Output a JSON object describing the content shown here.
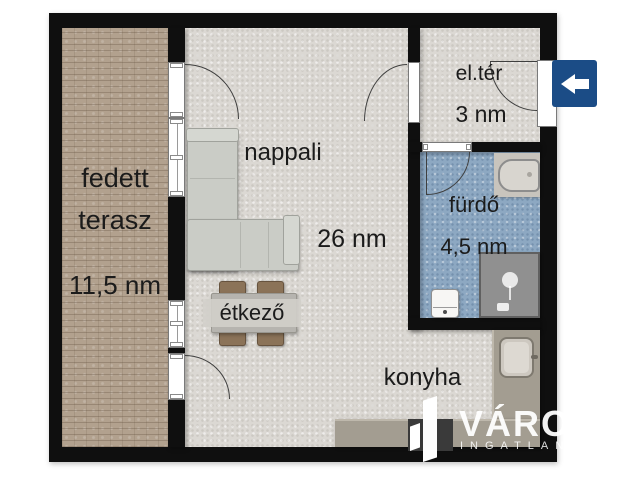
{
  "plan": {
    "rooms": {
      "terrace": {
        "line1": "fedett",
        "line2": "terasz",
        "area": "11,5 nm"
      },
      "living": {
        "name": "nappali",
        "area": "26 nm"
      },
      "dining": {
        "name": "étkező"
      },
      "kitchen": {
        "name": "konyha"
      },
      "entry": {
        "name": "el.tér",
        "area": "3 nm"
      },
      "bathroom": {
        "name": "fürdő",
        "area": "4,5 nm"
      }
    },
    "entrance_arrow_direction": "left",
    "colors": {
      "wall": "#0f0f0f",
      "floor": "#dbd8d3",
      "terrace_floor": "#b2a18e",
      "bathroom_floor": "#8da8c2",
      "counter": "#a39d91",
      "entrance_sign": "#1b4c86",
      "sofa": "#caccc6",
      "chair": "#8b7358"
    }
  },
  "watermark": {
    "brand": "VÁRO",
    "subtitle": "INGATLAN"
  }
}
